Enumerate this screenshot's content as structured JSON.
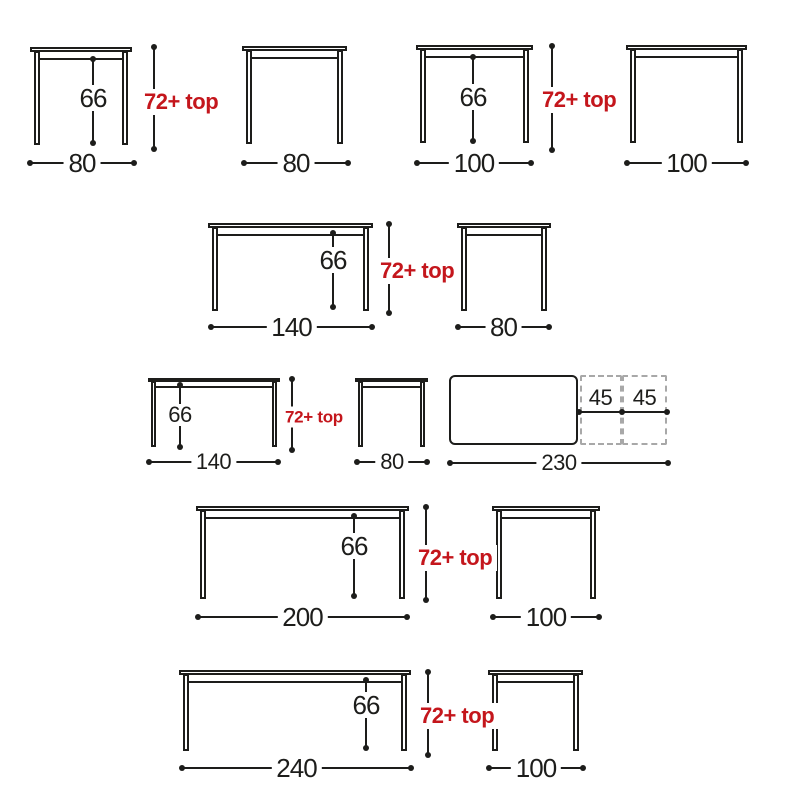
{
  "page": {
    "background": "#ffffff",
    "width": 800,
    "height": 800
  },
  "colors": {
    "line": "#1d1d1b",
    "accent_red": "#c4161c",
    "dash_gray": "#a8a8a8",
    "label_bg": "#ffffff"
  },
  "diagram": {
    "description": "table-size-dimension-drawings",
    "tables": [
      {
        "name": "table-80-front",
        "view": "front",
        "x": 30,
        "y": 47,
        "w": 102,
        "h": 98,
        "size": "lg",
        "inner": {
          "label": "66",
          "x": 93,
          "y1": 59,
          "y2": 143,
          "cy": 98
        },
        "dim": {
          "label": "80",
          "y": 163,
          "x1": 30,
          "x2": 134
        }
      },
      {
        "name": "table-80-side",
        "view": "side",
        "x": 242,
        "y": 46,
        "w": 105,
        "h": 98,
        "size": "lg",
        "dim": {
          "label": "80",
          "y": 163,
          "x1": 244,
          "x2": 348
        }
      },
      {
        "name": "table-100-front",
        "view": "front",
        "x": 416,
        "y": 45,
        "w": 117,
        "h": 98,
        "size": "lg",
        "inner": {
          "label": "66",
          "x": 473,
          "y1": 57,
          "y2": 141,
          "cy": 97
        },
        "dim": {
          "label": "100",
          "y": 163,
          "x1": 417,
          "x2": 531
        }
      },
      {
        "name": "table-100-side",
        "view": "side",
        "x": 626,
        "y": 45,
        "w": 121,
        "h": 98,
        "size": "lg",
        "dim": {
          "label": "100",
          "y": 163,
          "x1": 627,
          "x2": 746
        }
      },
      {
        "name": "table-140-front",
        "view": "front",
        "x": 208,
        "y": 223,
        "w": 165,
        "h": 88,
        "size": "lg",
        "inner": {
          "label": "66",
          "x": 333,
          "y1": 233,
          "y2": 307,
          "cy": 260
        },
        "dim": {
          "label": "140",
          "y": 327,
          "x1": 211,
          "x2": 372
        }
      },
      {
        "name": "table-80-side-2",
        "view": "side",
        "x": 457,
        "y": 223,
        "w": 94,
        "h": 88,
        "size": "lg",
        "dim": {
          "label": "80",
          "y": 327,
          "x1": 458,
          "x2": 549
        }
      },
      {
        "name": "table-140-front-small",
        "view": "front",
        "x": 148,
        "y": 378,
        "w": 132,
        "h": 69,
        "size": "sm",
        "inner": {
          "label": "66",
          "x": 180,
          "y1": 385,
          "y2": 447,
          "cy": 415
        },
        "dim": {
          "label": "140",
          "y": 462,
          "x1": 149,
          "x2": 278
        }
      },
      {
        "name": "table-80-side-small",
        "view": "side",
        "x": 355,
        "y": 378,
        "w": 73,
        "h": 69,
        "size": "sm",
        "dim": {
          "label": "80",
          "y": 462,
          "x1": 357,
          "x2": 427
        }
      },
      {
        "name": "table-200-front",
        "view": "front",
        "x": 196,
        "y": 506,
        "w": 213,
        "h": 93,
        "size": "lg",
        "inner": {
          "label": "66",
          "x": 354,
          "y1": 516,
          "y2": 596,
          "cy": 546
        },
        "dim": {
          "label": "200",
          "y": 617,
          "x1": 198,
          "x2": 407
        }
      },
      {
        "name": "table-100-side-2",
        "view": "side",
        "x": 492,
        "y": 506,
        "w": 108,
        "h": 93,
        "size": "lg",
        "dim": {
          "label": "100",
          "y": 617,
          "x1": 493,
          "x2": 599
        }
      },
      {
        "name": "table-240-front",
        "view": "front",
        "x": 179,
        "y": 670,
        "w": 232,
        "h": 81,
        "size": "lg",
        "inner": {
          "label": "66",
          "x": 366,
          "y1": 680,
          "y2": 748,
          "cy": 705
        },
        "dim": {
          "label": "240",
          "y": 768,
          "x1": 182,
          "x2": 411
        }
      },
      {
        "name": "table-100-side-3",
        "view": "side",
        "x": 488,
        "y": 670,
        "w": 95,
        "h": 81,
        "size": "lg",
        "dim": {
          "label": "100",
          "y": 768,
          "x1": 489,
          "x2": 583
        }
      }
    ],
    "height_dims": [
      {
        "label": "72+ top",
        "x": 154,
        "y1": 47,
        "y2": 149,
        "lx": 142,
        "cy": 102,
        "size": "lg"
      },
      {
        "label": "72+ top",
        "x": 552,
        "y1": 46,
        "y2": 150,
        "lx": 540,
        "cy": 100,
        "size": "lg"
      },
      {
        "label": "72+ top",
        "x": 389,
        "y1": 224,
        "y2": 313,
        "lx": 378,
        "cy": 271,
        "size": "lg"
      },
      {
        "label": "72+ top",
        "x": 292,
        "y1": 379,
        "y2": 450,
        "lx": 283,
        "cy": 417,
        "size": "sm"
      },
      {
        "label": "72+ top",
        "x": 426,
        "y1": 507,
        "y2": 600,
        "lx": 416,
        "cy": 558,
        "size": "lg"
      },
      {
        "label": "72+ top",
        "x": 428,
        "y1": 672,
        "y2": 755,
        "lx": 418,
        "cy": 716,
        "size": "lg"
      }
    ],
    "top_view": {
      "solid": {
        "x": 449,
        "y": 375,
        "w": 129,
        "h": 70,
        "r": 6
      },
      "extensions": [
        {
          "label": "45",
          "x": 580,
          "y": 375,
          "w": 42,
          "h": 70
        },
        {
          "label": "45",
          "x": 622,
          "y": 375,
          "w": 45,
          "h": 70
        }
      ],
      "ext_dim": {
        "y": 412,
        "points": [
          579,
          622,
          667
        ],
        "label_y": 410
      },
      "dim": {
        "label": "230",
        "y": 463,
        "x1": 450,
        "x2": 668
      }
    }
  }
}
